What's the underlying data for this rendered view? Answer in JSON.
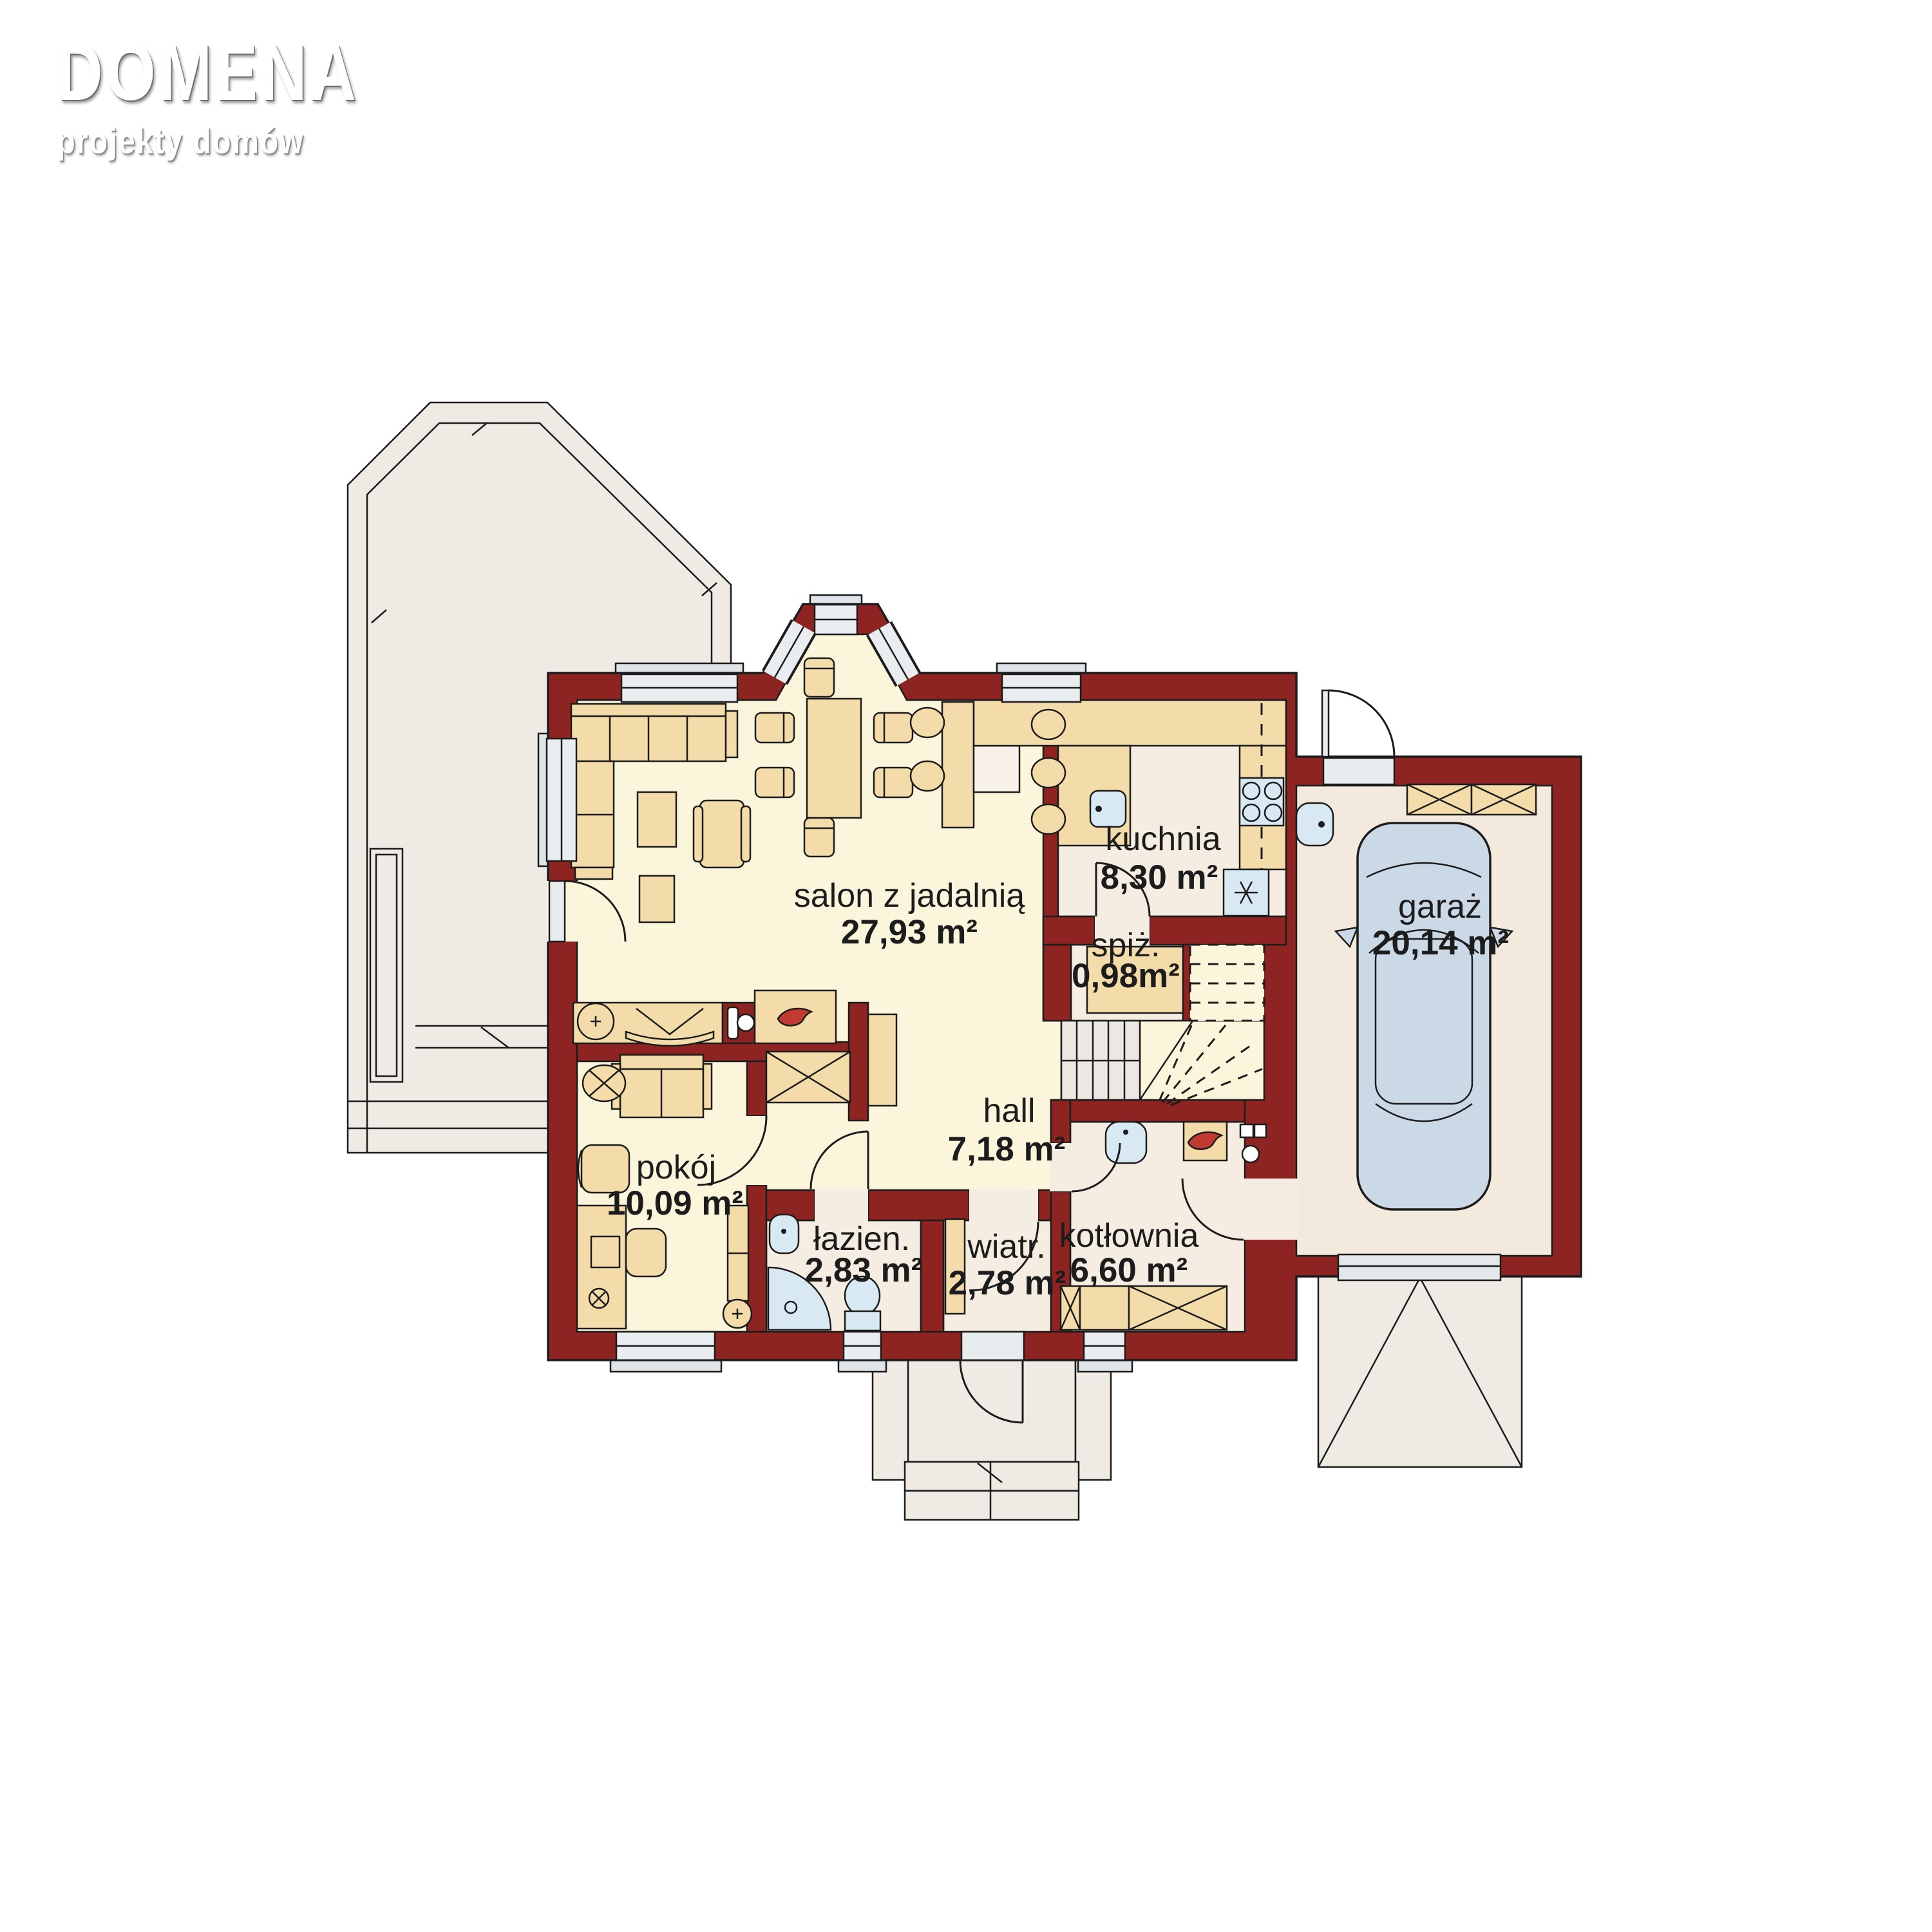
{
  "brand": {
    "name": "DOMENA",
    "tagline": "projekty domów"
  },
  "plan": {
    "title": "parter — rzut kondygnacji",
    "rooms": [
      {
        "id": "salon",
        "label": "salon z jadalnią",
        "area": "27,93 m²"
      },
      {
        "id": "kuchnia",
        "label": "kuchnia",
        "area": "8,30 m²"
      },
      {
        "id": "spizarnia",
        "label": "spiż.",
        "area": "0,98m²"
      },
      {
        "id": "garaz",
        "label": "garaż",
        "area": "20,14 m²"
      },
      {
        "id": "hall",
        "label": "hall",
        "area": "7,18 m²"
      },
      {
        "id": "pokoj",
        "label": "pokój",
        "area": "10,09 m²"
      },
      {
        "id": "lazienka",
        "label": "łazien.",
        "area": "2,83 m²"
      },
      {
        "id": "wiatrolap",
        "label": "wiatr.",
        "area": "2,78 m²"
      },
      {
        "id": "kotlownia",
        "label": "kotłownia",
        "area": "6,60 m²"
      }
    ],
    "icons": [
      "stove-icon",
      "sink-icon",
      "fridge-snowflake-icon",
      "boiler-flame-icon",
      "fireplace-flame-icon",
      "shower-icon",
      "toilet-icon",
      "plant-icon",
      "car-icon",
      "wardrobe-x-icon",
      "stairs-icon",
      "door-swing-icon"
    ],
    "colors": {
      "wall": "#8D2422",
      "living_floor": "#FBF5DC",
      "service_floor": "#F6EDE2",
      "garage_floor": "#F3EADD",
      "furniture": "#F3DCA9",
      "fixture": "#D9E9F3",
      "car": "#CBD8E6",
      "outside": "#EFEBE4",
      "window": "#E9EDF0",
      "flame": "#C23B32",
      "line": "#1C1C1C"
    }
  }
}
